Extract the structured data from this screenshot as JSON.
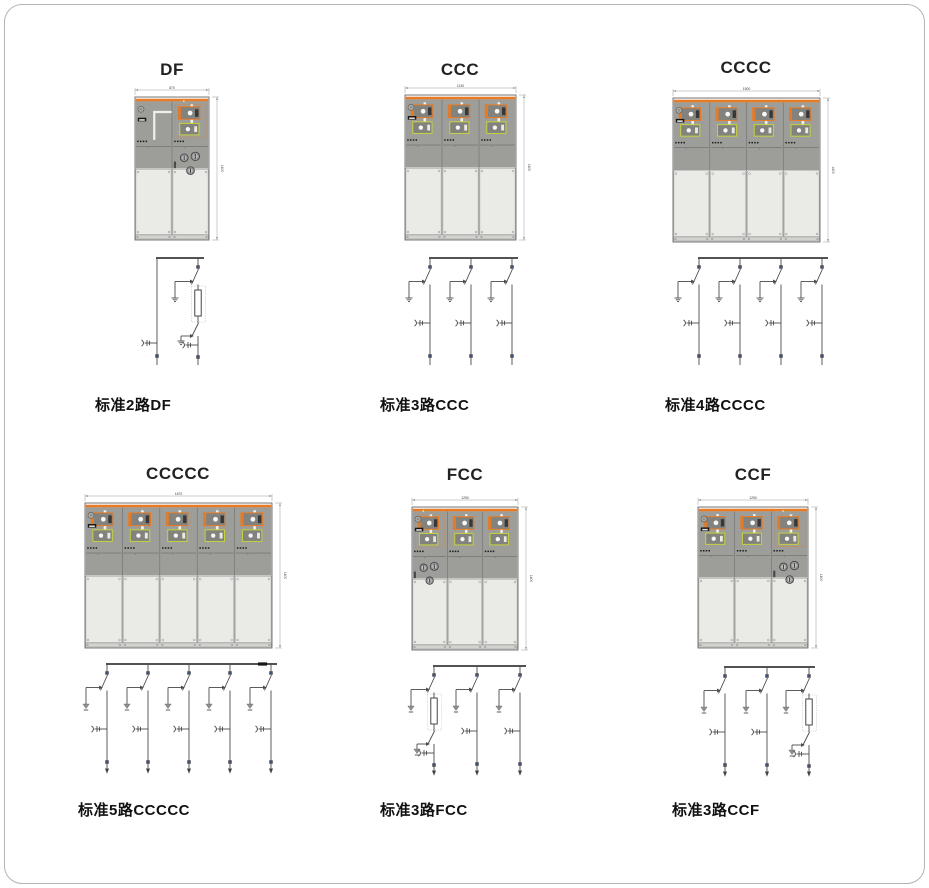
{
  "page": {
    "background": "#ffffff",
    "frame_color": "#b3b3b3"
  },
  "colors": {
    "accent_orange": "#e87c26",
    "accent_yellow_green": "#c6d23c",
    "cabinet_gray": "#9d9d99",
    "cabinet_light_gray": "#eaeae7",
    "schematic_line": "#4a4a4a",
    "node_blue": "#3457a6",
    "earth_gray": "#8f8f8f"
  },
  "groups": [
    {
      "id": "df",
      "title": "DF",
      "caption": "标准2路DF",
      "bays": [
        "D",
        "F"
      ],
      "ways": [
        "P",
        "F"
      ],
      "dim_width": "870",
      "dim_height": "1400",
      "earth_style": "bars",
      "bus_end": false
    },
    {
      "id": "ccc",
      "title": "CCC",
      "caption": "标准3路CCC",
      "bays": [
        "C",
        "C",
        "C"
      ],
      "ways": [
        "C",
        "C",
        "C"
      ],
      "dim_width": "1130",
      "dim_height": "1400",
      "earth_style": "bars",
      "bus_end": false
    },
    {
      "id": "cccc",
      "title": "CCCC",
      "caption": "标准4路CCCC",
      "bays": [
        "C",
        "C",
        "C",
        "C"
      ],
      "ways": [
        "C",
        "C",
        "C",
        "C"
      ],
      "dim_width": "1500",
      "dim_height": "1400",
      "earth_style": "bars",
      "bus_end": false
    },
    {
      "id": "ccccc",
      "title": "CCCCC",
      "caption": "标准5路CCCCC",
      "bays": [
        "C",
        "C",
        "C",
        "C",
        "C"
      ],
      "ways": [
        "C",
        "C",
        "C",
        "C",
        "C"
      ],
      "dim_width": "1870",
      "dim_height": "1400",
      "earth_style": "triangle",
      "bus_end": true
    },
    {
      "id": "fcc",
      "title": "FCC",
      "caption": "标准3路FCC",
      "bays": [
        "F",
        "C",
        "C"
      ],
      "ways": [
        "F",
        "C",
        "C"
      ],
      "dim_width": "1250",
      "dim_height": "1400",
      "earth_style": "triangle",
      "bus_end": false
    },
    {
      "id": "ccf",
      "title": "CCF",
      "caption": "标准3路CCF",
      "bays": [
        "C",
        "C",
        "F"
      ],
      "ways": [
        "C",
        "C",
        "F"
      ],
      "dim_width": "1250",
      "dim_height": "1400",
      "earth_style": "triangle",
      "bus_end": false
    }
  ]
}
